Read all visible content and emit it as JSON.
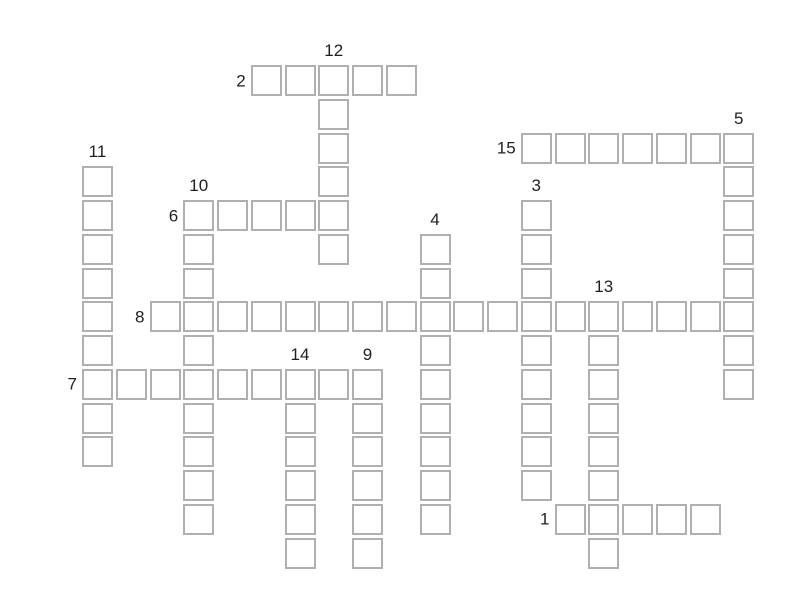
{
  "app": {
    "background_color": "#ffffff"
  },
  "puzzle": {
    "type": "crossword-grid",
    "grid": {
      "origin_x": 82,
      "origin_y": 65,
      "pitch": 33.75,
      "cell_outer": 31,
      "cell_border_color": "#b0b0b0",
      "cell_fill_color": "#ffffff",
      "number_color": "#1f1f1f",
      "number_font_size": 17
    },
    "words": [
      {
        "number": "1",
        "direction": "across",
        "col": 14,
        "row": 13,
        "length": 5
      },
      {
        "number": "2",
        "direction": "across",
        "col": 5,
        "row": 0,
        "length": 5
      },
      {
        "number": "3",
        "direction": "down",
        "col": 13,
        "row": 4,
        "length": 9
      },
      {
        "number": "4",
        "direction": "down",
        "col": 10,
        "row": 5,
        "length": 9
      },
      {
        "number": "5",
        "direction": "down",
        "col": 19,
        "row": 2,
        "length": 8
      },
      {
        "number": "6",
        "direction": "across",
        "col": 3,
        "row": 4,
        "length": 5
      },
      {
        "number": "7",
        "direction": "across",
        "col": 0,
        "row": 9,
        "length": 9
      },
      {
        "number": "8",
        "direction": "across",
        "col": 2,
        "row": 7,
        "length": 18
      },
      {
        "number": "9",
        "direction": "down",
        "col": 8,
        "row": 9,
        "length": 6
      },
      {
        "number": "10",
        "direction": "down",
        "col": 3,
        "row": 4,
        "length": 10
      },
      {
        "number": "11",
        "direction": "down",
        "col": 0,
        "row": 3,
        "length": 9
      },
      {
        "number": "12",
        "direction": "down",
        "col": 7,
        "row": 0,
        "length": 6
      },
      {
        "number": "13",
        "direction": "down",
        "col": 15,
        "row": 7,
        "length": 8
      },
      {
        "number": "14",
        "direction": "down",
        "col": 6,
        "row": 9,
        "length": 6
      },
      {
        "number": "15",
        "direction": "across",
        "col": 13,
        "row": 2,
        "length": 7
      }
    ]
  }
}
